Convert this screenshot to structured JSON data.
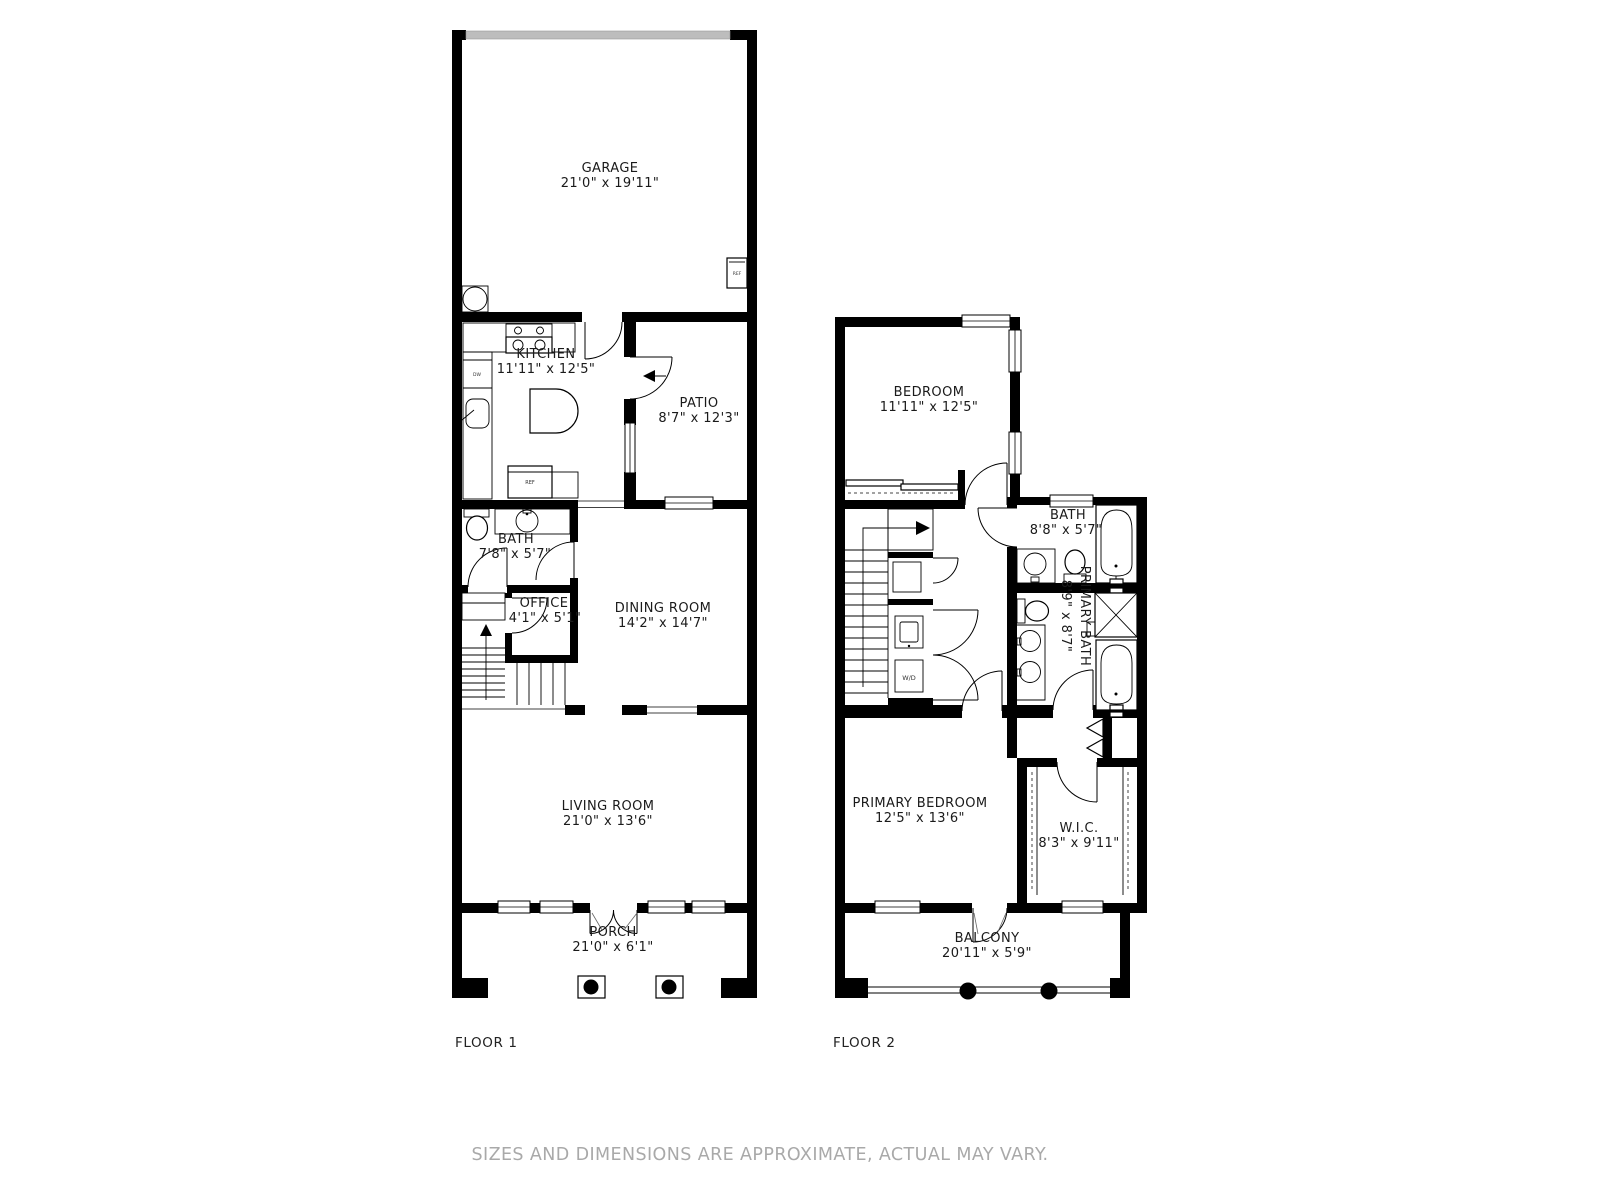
{
  "disclaimer": "SIZES AND DIMENSIONS ARE APPROXIMATE, ACTUAL MAY VARY.",
  "colors": {
    "wall": "#000000",
    "room_label_text": "#1a1a1a",
    "disclaimer_text": "#a9a9a9",
    "garage_door": "#bdbdbd"
  },
  "floor1": {
    "label": "FLOOR 1",
    "rooms": {
      "garage": {
        "name": "GARAGE",
        "dims": "21'0\" x 19'11\""
      },
      "kitchen": {
        "name": "KITCHEN",
        "dims": "11'11\" x 12'5\""
      },
      "patio": {
        "name": "PATIO",
        "dims": "8'7\" x 12'3\""
      },
      "bath": {
        "name": "BATH",
        "dims": "7'8\" x 5'7\""
      },
      "office": {
        "name": "OFFICE",
        "dims": "4'1\" x 5'1\""
      },
      "dining": {
        "name": "DINING ROOM",
        "dims": "14'2\" x 14'7\""
      },
      "living": {
        "name": "LIVING ROOM",
        "dims": "21'0\" x 13'6\""
      },
      "porch": {
        "name": "PORCH",
        "dims": "21'0\" x 6'1\""
      }
    },
    "fixtures": {
      "garage_ref": "REF",
      "kitchen_ref": "REF",
      "dishwasher": "DW"
    }
  },
  "floor2": {
    "label": "FLOOR 2",
    "rooms": {
      "bedroom": {
        "name": "BEDROOM",
        "dims": "11'11\" x 12'5\""
      },
      "bath": {
        "name": "BATH",
        "dims": "8'8\" x 5'7\""
      },
      "primary_bath": {
        "name": "PRIMARY BATH",
        "dims": "8'9\" x 8'7\""
      },
      "primary_bedroom": {
        "name": "PRIMARY BEDROOM",
        "dims": "12'5\" x 13'6\""
      },
      "wic": {
        "name": "W.I.C.",
        "dims": "8'3\" x 9'11\""
      },
      "balcony": {
        "name": "BALCONY",
        "dims": "20'11\" x 5'9\""
      }
    },
    "fixtures": {
      "washer_dryer": "W/D"
    }
  }
}
